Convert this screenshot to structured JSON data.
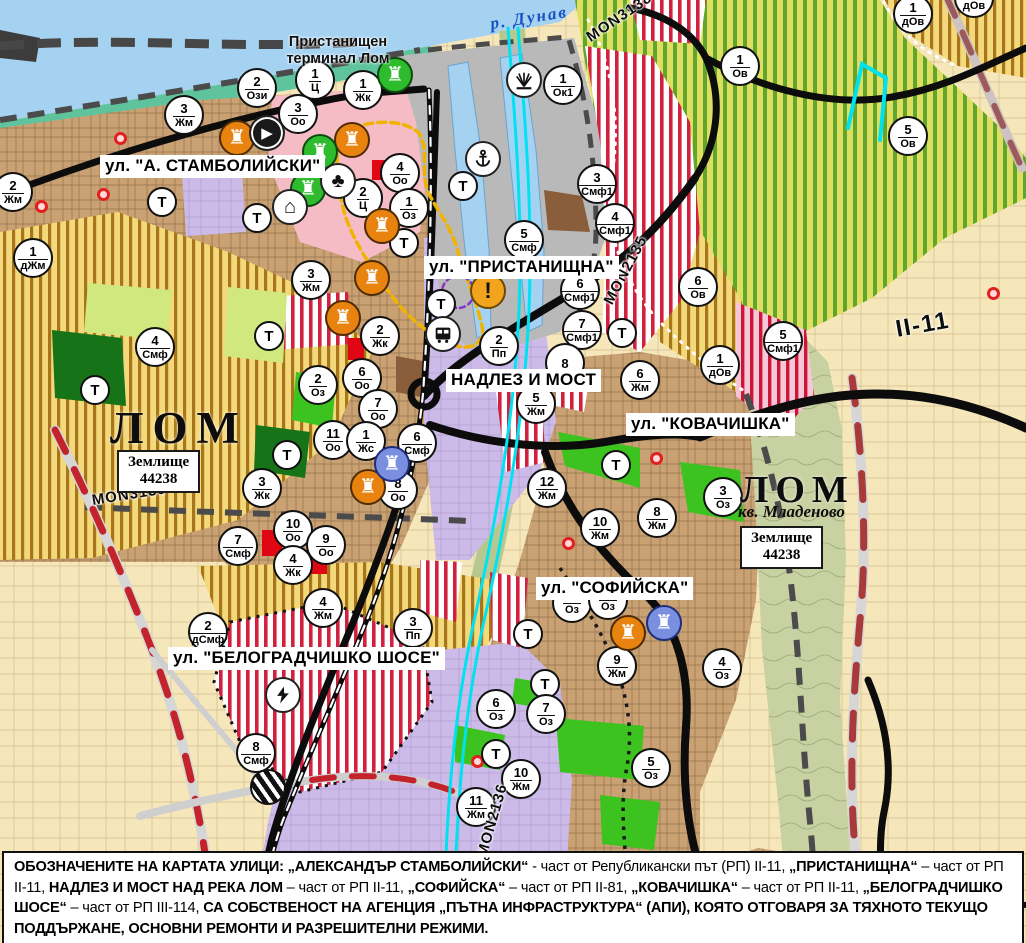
{
  "palette": {
    "water": "#a6d2f2",
    "shore_green": "#5fc49e",
    "vineyard_stripe": "#61a62c",
    "agri_stripe": "#a8761a",
    "crimson_stripe": "#d2213e",
    "urban_tan": "#c9a173",
    "industrial_lavender": "#ccbbe8",
    "park_green": "#3cc31f",
    "dark_green": "#177317",
    "port_gray": "#b9b9b9",
    "road_black": "#0c0c0c",
    "repair_red_dash": "#c3242c",
    "channel_cyan": "#00e2f2",
    "marker_orange": "#e8830f",
    "marker_green": "#2ebb2e",
    "marker_blue": "#7b8fe0",
    "warning_amber": "#f2a51c"
  },
  "map": {
    "river_label": {
      "text": "р. Дунав"
    },
    "port_label": {
      "line1": "Пристанищен",
      "line2": "терминал Лом"
    },
    "city_labels": [
      {
        "text": "ЛОМ"
      },
      {
        "text": "ЛОМ"
      }
    ],
    "district_label": {
      "text": "кв. Младеново"
    },
    "land_boxes": [
      {
        "line1": "Землище",
        "line2": "44238"
      },
      {
        "line1": "Землище",
        "line2": "44238"
      }
    ],
    "street_labels": [
      {
        "text": "ул. \"А. СТАМБОЛИЙСКИ\"",
        "x": 100,
        "y": 155
      },
      {
        "text": "ул. \"ПРИСТАНИЩНА\"",
        "x": 424,
        "y": 256
      },
      {
        "text": "НАДЛЕЗ И МОСТ",
        "x": 446,
        "y": 369
      },
      {
        "text": "ул. \"КОВАЧИШКА\"",
        "x": 626,
        "y": 413
      },
      {
        "text": "ул. \"СОФИЙСКА\"",
        "x": 536,
        "y": 577
      },
      {
        "text": "ул. \"БЕЛОГРАДЧИШКО ШОСЕ\"",
        "x": 168,
        "y": 647
      }
    ],
    "road_labels": [
      {
        "text": "MON3138",
        "x": 588,
        "y": 30,
        "angle": -34,
        "big": false
      },
      {
        "text": "MON2135",
        "x": 608,
        "y": 295,
        "angle": -62,
        "big": false
      },
      {
        "text": "MON3139",
        "x": 92,
        "y": 492,
        "angle": -9,
        "big": false
      },
      {
        "text": "MON2136",
        "x": 482,
        "y": 848,
        "angle": -74,
        "big": false
      },
      {
        "text": "II-11",
        "x": 896,
        "y": 316,
        "angle": -10,
        "big": true
      }
    ],
    "zone_markers": [
      {
        "x": 257,
        "y": 88,
        "n": "2",
        "c": "Ози"
      },
      {
        "x": 315,
        "y": 80,
        "n": "1",
        "c": "Ц"
      },
      {
        "x": 363,
        "y": 90,
        "n": "1",
        "c": "Жк"
      },
      {
        "x": 298,
        "y": 114,
        "n": "3",
        "c": "Оо"
      },
      {
        "x": 184,
        "y": 115,
        "n": "3",
        "c": "Жм"
      },
      {
        "x": 13,
        "y": 192,
        "n": "2",
        "c": "Жм"
      },
      {
        "x": 33,
        "y": 258,
        "n": "1",
        "c": "дЖм"
      },
      {
        "x": 311,
        "y": 280,
        "n": "3",
        "c": "Жм"
      },
      {
        "x": 400,
        "y": 173,
        "n": "4",
        "c": "Оо"
      },
      {
        "x": 363,
        "y": 198,
        "n": "2",
        "c": "Ц"
      },
      {
        "x": 409,
        "y": 208,
        "n": "1",
        "c": "Оз"
      },
      {
        "x": 524,
        "y": 240,
        "n": "5",
        "c": "Смф"
      },
      {
        "x": 563,
        "y": 85,
        "n": "1",
        "c": "Ок1"
      },
      {
        "x": 597,
        "y": 184,
        "n": "3",
        "c": "Смф1"
      },
      {
        "x": 615,
        "y": 223,
        "n": "4",
        "c": "Смф1"
      },
      {
        "x": 698,
        "y": 287,
        "n": "6",
        "c": "Ов"
      },
      {
        "x": 740,
        "y": 66,
        "n": "1",
        "c": "Ов"
      },
      {
        "x": 908,
        "y": 136,
        "n": "5",
        "c": "Ов"
      },
      {
        "x": 913,
        "y": 14,
        "n": "1",
        "c": "дОв"
      },
      {
        "x": 974,
        "y": -2,
        "n": "1",
        "c": "дОв"
      },
      {
        "x": 720,
        "y": 365,
        "n": "1",
        "c": "дОв"
      },
      {
        "x": 783,
        "y": 341,
        "n": "5",
        "c": "Смф1"
      },
      {
        "x": 580,
        "y": 290,
        "n": "6",
        "c": "Смф1"
      },
      {
        "x": 582,
        "y": 330,
        "n": "7",
        "c": "Смф1"
      },
      {
        "x": 565,
        "y": 363,
        "n": "8",
        "c": ""
      },
      {
        "x": 536,
        "y": 404,
        "n": "5",
        "c": "Жм"
      },
      {
        "x": 640,
        "y": 380,
        "n": "6",
        "c": "Жм"
      },
      {
        "x": 547,
        "y": 488,
        "n": "12",
        "c": "Жм"
      },
      {
        "x": 600,
        "y": 528,
        "n": "10",
        "c": "Жм"
      },
      {
        "x": 657,
        "y": 518,
        "n": "8",
        "c": "Жм"
      },
      {
        "x": 723,
        "y": 497,
        "n": "3",
        "c": "Оз"
      },
      {
        "x": 499,
        "y": 346,
        "n": "2",
        "c": "Пп"
      },
      {
        "x": 380,
        "y": 336,
        "n": "2",
        "c": "Жк"
      },
      {
        "x": 318,
        "y": 385,
        "n": "2",
        "c": "Оз"
      },
      {
        "x": 362,
        "y": 378,
        "n": "6",
        "c": "Оо"
      },
      {
        "x": 378,
        "y": 409,
        "n": "7",
        "c": "Оо"
      },
      {
        "x": 333,
        "y": 440,
        "n": "11",
        "c": "Оо"
      },
      {
        "x": 366,
        "y": 441,
        "n": "1",
        "c": "Жс"
      },
      {
        "x": 417,
        "y": 443,
        "n": "6",
        "c": "Смф"
      },
      {
        "x": 398,
        "y": 490,
        "n": "8",
        "c": "Оо"
      },
      {
        "x": 262,
        "y": 488,
        "n": "3",
        "c": "Жк"
      },
      {
        "x": 293,
        "y": 530,
        "n": "10",
        "c": "Оо"
      },
      {
        "x": 326,
        "y": 545,
        "n": "9",
        "c": "Оо"
      },
      {
        "x": 293,
        "y": 565,
        "n": "4",
        "c": "Жк"
      },
      {
        "x": 323,
        "y": 608,
        "n": "4",
        "c": "Жм"
      },
      {
        "x": 413,
        "y": 628,
        "n": "3",
        "c": "Пп"
      },
      {
        "x": 208,
        "y": 632,
        "n": "2",
        "c": "дСмф"
      },
      {
        "x": 256,
        "y": 753,
        "n": "8",
        "c": "Смф"
      },
      {
        "x": 238,
        "y": 546,
        "n": "7",
        "c": "Смф"
      },
      {
        "x": 155,
        "y": 347,
        "n": "4",
        "c": "Смф"
      },
      {
        "x": 496,
        "y": 709,
        "n": "6",
        "c": "Оз"
      },
      {
        "x": 546,
        "y": 714,
        "n": "7",
        "c": "Оз"
      },
      {
        "x": 651,
        "y": 768,
        "n": "5",
        "c": "Оз"
      },
      {
        "x": 521,
        "y": 779,
        "n": "10",
        "c": "Жм"
      },
      {
        "x": 476,
        "y": 807,
        "n": "11",
        "c": "Жм"
      },
      {
        "x": 617,
        "y": 666,
        "n": "9",
        "c": "Жм"
      },
      {
        "x": 722,
        "y": 668,
        "n": "4",
        "c": "Оз"
      },
      {
        "x": 572,
        "y": 603,
        "n": "",
        "c": "Оз"
      },
      {
        "x": 608,
        "y": 600,
        "n": "",
        "c": "Оз"
      }
    ],
    "t_markers": [
      {
        "x": 162,
        "y": 202
      },
      {
        "x": 257,
        "y": 218
      },
      {
        "x": 269,
        "y": 336
      },
      {
        "x": 287,
        "y": 455
      },
      {
        "x": 95,
        "y": 390
      },
      {
        "x": 463,
        "y": 186
      },
      {
        "x": 404,
        "y": 243
      },
      {
        "x": 441,
        "y": 304
      },
      {
        "x": 622,
        "y": 333
      },
      {
        "x": 616,
        "y": 465
      },
      {
        "x": 528,
        "y": 634
      },
      {
        "x": 545,
        "y": 684
      },
      {
        "x": 496,
        "y": 754
      }
    ],
    "t_label": "Т",
    "icons": [
      {
        "x": 237,
        "y": 138,
        "type": "monument",
        "color": "orange",
        "name": "cultural-site-icon"
      },
      {
        "x": 352,
        "y": 140,
        "type": "monument",
        "color": "orange",
        "name": "cultural-site-icon"
      },
      {
        "x": 382,
        "y": 226,
        "type": "monument",
        "color": "orange",
        "name": "cultural-site-icon"
      },
      {
        "x": 343,
        "y": 318,
        "type": "monument",
        "color": "orange",
        "name": "cultural-site-icon"
      },
      {
        "x": 372,
        "y": 278,
        "type": "monument",
        "color": "orange",
        "name": "cultural-site-icon"
      },
      {
        "x": 368,
        "y": 487,
        "type": "monument",
        "color": "orange",
        "name": "cultural-site-icon"
      },
      {
        "x": 628,
        "y": 633,
        "type": "monument",
        "color": "orange",
        "name": "cultural-site-icon"
      },
      {
        "x": 395,
        "y": 75,
        "type": "monument",
        "color": "green",
        "name": "cultural-site-icon"
      },
      {
        "x": 320,
        "y": 152,
        "type": "monument",
        "color": "green",
        "name": "cultural-site-icon"
      },
      {
        "x": 308,
        "y": 189,
        "type": "monument",
        "color": "green",
        "name": "cultural-site-icon"
      },
      {
        "x": 392,
        "y": 464,
        "type": "monument",
        "color": "blue",
        "name": "cultural-site-icon"
      },
      {
        "x": 664,
        "y": 623,
        "type": "monument",
        "color": "blue",
        "name": "cultural-site-icon"
      },
      {
        "x": 267,
        "y": 133,
        "type": "arrow",
        "color": "dark",
        "name": "direction-icon"
      },
      {
        "x": 338,
        "y": 181,
        "type": "trefoil",
        "color": "white",
        "name": "club-monument-icon"
      },
      {
        "x": 290,
        "y": 207,
        "type": "arch",
        "color": "white",
        "name": "arch-monument-icon"
      },
      {
        "x": 483,
        "y": 159,
        "type": "anchor",
        "color": "white",
        "name": "port-anchor-icon"
      },
      {
        "x": 524,
        "y": 80,
        "type": "crane",
        "color": "white",
        "name": "port-crane-icon"
      },
      {
        "x": 488,
        "y": 291,
        "type": "warning",
        "color": "warning",
        "name": "warning-icon"
      },
      {
        "x": 443,
        "y": 334,
        "type": "bus",
        "color": "white",
        "name": "bus-station-icon"
      },
      {
        "x": 283,
        "y": 695,
        "type": "lightning",
        "color": "white",
        "name": "substation-icon"
      },
      {
        "x": 268,
        "y": 787,
        "type": "railx",
        "color": "railx",
        "name": "rail-crossing-icon"
      }
    ],
    "red_dots": [
      {
        "x": 120,
        "y": 138
      },
      {
        "x": 103,
        "y": 194
      },
      {
        "x": 41,
        "y": 206
      },
      {
        "x": 568,
        "y": 543
      },
      {
        "x": 656,
        "y": 458
      },
      {
        "x": 477,
        "y": 761
      },
      {
        "x": 993,
        "y": 293
      }
    ]
  },
  "note": {
    "segments": [
      {
        "t": "ОБОЗНАЧЕНИТЕ НА КАРТАТА УЛИЦИ: „АЛЕКСАНДЪР СТАМБОЛИЙСКИ“",
        "b": true
      },
      {
        "t": " - част от Републикански път (РП) II-11, ",
        "b": false
      },
      {
        "t": "„ПРИСТАНИЩНА“",
        "b": true
      },
      {
        "t": " – част от РП II-11, ",
        "b": false
      },
      {
        "t": "НАДЛЕЗ И МОСТ НАД РЕКА ЛОМ",
        "b": true
      },
      {
        "t": " – част от РП II-11, ",
        "b": false
      },
      {
        "t": "„СОФИЙСКА“",
        "b": true
      },
      {
        "t": " – част от РП II-81, ",
        "b": false
      },
      {
        "t": "„КОВАЧИШКА“",
        "b": true
      },
      {
        "t": " – част от РП II-11, ",
        "b": false
      },
      {
        "t": "„БЕЛОГРАДЧИШКО ШОСЕ“",
        "b": true
      },
      {
        "t": " – част от РП III-114, ",
        "b": false
      },
      {
        "t": "СА СОБСТВЕНОСТ НА АГЕНЦИЯ „ПЪТНА ИНФРАСТРУКТУРА“ (АПИ), КОЯТО ОТГОВАРЯ ЗА ТЯХНОТО ТЕКУЩО ПОДДЪРЖАНЕ, ОСНОВНИ РЕМОНТИ И РАЗРЕШИТЕЛНИ РЕЖИМИ.",
        "b": true
      }
    ]
  }
}
